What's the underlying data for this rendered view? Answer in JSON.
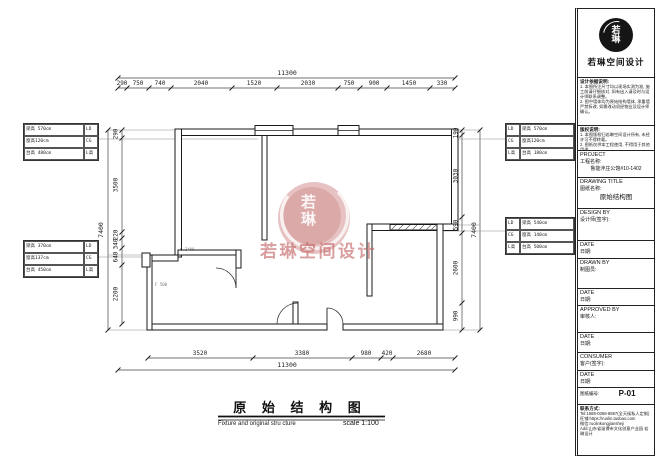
{
  "plan": {
    "title_cn": "原 始 结 构 图",
    "title_en": "Fixture and original stru cture",
    "scale_label": "scale 1:100",
    "note_a": "C 2400",
    "note_b": "F 500"
  },
  "watermark": {
    "stamp_chars": "若琳",
    "text": "若琳空间设计",
    "color": "#c06060"
  },
  "dims": {
    "top": {
      "overall": "11300",
      "segments": [
        "290",
        "750",
        "740",
        "2040",
        "1520",
        "2030",
        "750",
        "900",
        "1450",
        "330"
      ]
    },
    "bottom": {
      "overall": "11300",
      "segments": [
        "3520",
        "3380",
        "980",
        "420",
        "2680"
      ]
    },
    "left": {
      "overall": "7400",
      "segments": [
        "290",
        "3500",
        "220",
        "340",
        "640",
        "2200"
      ]
    },
    "right": {
      "overall": "7400",
      "segments": [
        "190",
        "3030",
        "590",
        "2600",
        "990"
      ]
    }
  },
  "boxes": {
    "left_top": {
      "rows": [
        [
          "梁高 570cm",
          "LD"
        ],
        [
          "窗高120cm",
          "CG"
        ],
        [
          "台高 480cm",
          "L高"
        ]
      ]
    },
    "left_bottom": {
      "rows": [
        [
          "梁高 370cm",
          "LD"
        ],
        [
          "窗高137cm",
          "CG"
        ],
        [
          "台高 450cm",
          "L高"
        ]
      ]
    },
    "right_top": {
      "rows": [
        [
          "LD",
          "梁高 570cm"
        ],
        [
          "CG",
          "窗高120cm"
        ],
        [
          "L高",
          "台高 180cm"
        ]
      ]
    },
    "right_bottom": {
      "rows": [
        [
          "LD",
          "梁高 540cm"
        ],
        [
          "CG",
          "窗高 140cm"
        ],
        [
          "L高",
          "台高 500cm"
        ]
      ]
    }
  },
  "titleblock": {
    "brand": "若琳空间设计",
    "stamp_chars": "若琳",
    "notes1_title": "设计依据说明:",
    "notes1": [
      "1. 本图所注尺寸均以现场实测为准, 施工前请仔细核对, 如有出入请及时与设计师联系调整。",
      "2. 图中墙体均为原始结构墙体, 承重墙严禁拆改, 如需改动须经物业及设计师确认。"
    ],
    "notes2_title": "版权说明:",
    "notes2": [
      "1. 本图版权归若琳空间设计所有, 未经许可不得转载。",
      "2. 图纸仅供本工程使用, 不得用于其他用途。"
    ],
    "project_en": "PROJECT",
    "project_cn": "工程名称:",
    "project_value": "鲁能泮庄公馆#10-1402",
    "title_en": "DRAWING TITLE",
    "title_cn": "图纸名称:",
    "title_value": "原始结构图",
    "design_en": "DESIGN BY",
    "design_cn": "设计师(签字):",
    "date_en": "DATE",
    "date_cn": "日期:",
    "drawn_en": "DRAWN BY",
    "drawn_cn": "制图员:",
    "approved_en": "APPROVED BY",
    "approved_cn": "审核人:",
    "consumer_en": "CONSUMER",
    "consumer_cn": "客户(签字):",
    "number_label": "图纸编号:",
    "number_value": "P-01",
    "contact_label": "联系方式:",
    "contact": [
      "Tel:1588-0368-8867(全天候私人定制)",
      "旺铺:https://ruolin.taobao.com",
      "微信:ruolinkongjiansheji",
      "Add:山东省淄博市文化创意产业园 若琳设计"
    ]
  }
}
